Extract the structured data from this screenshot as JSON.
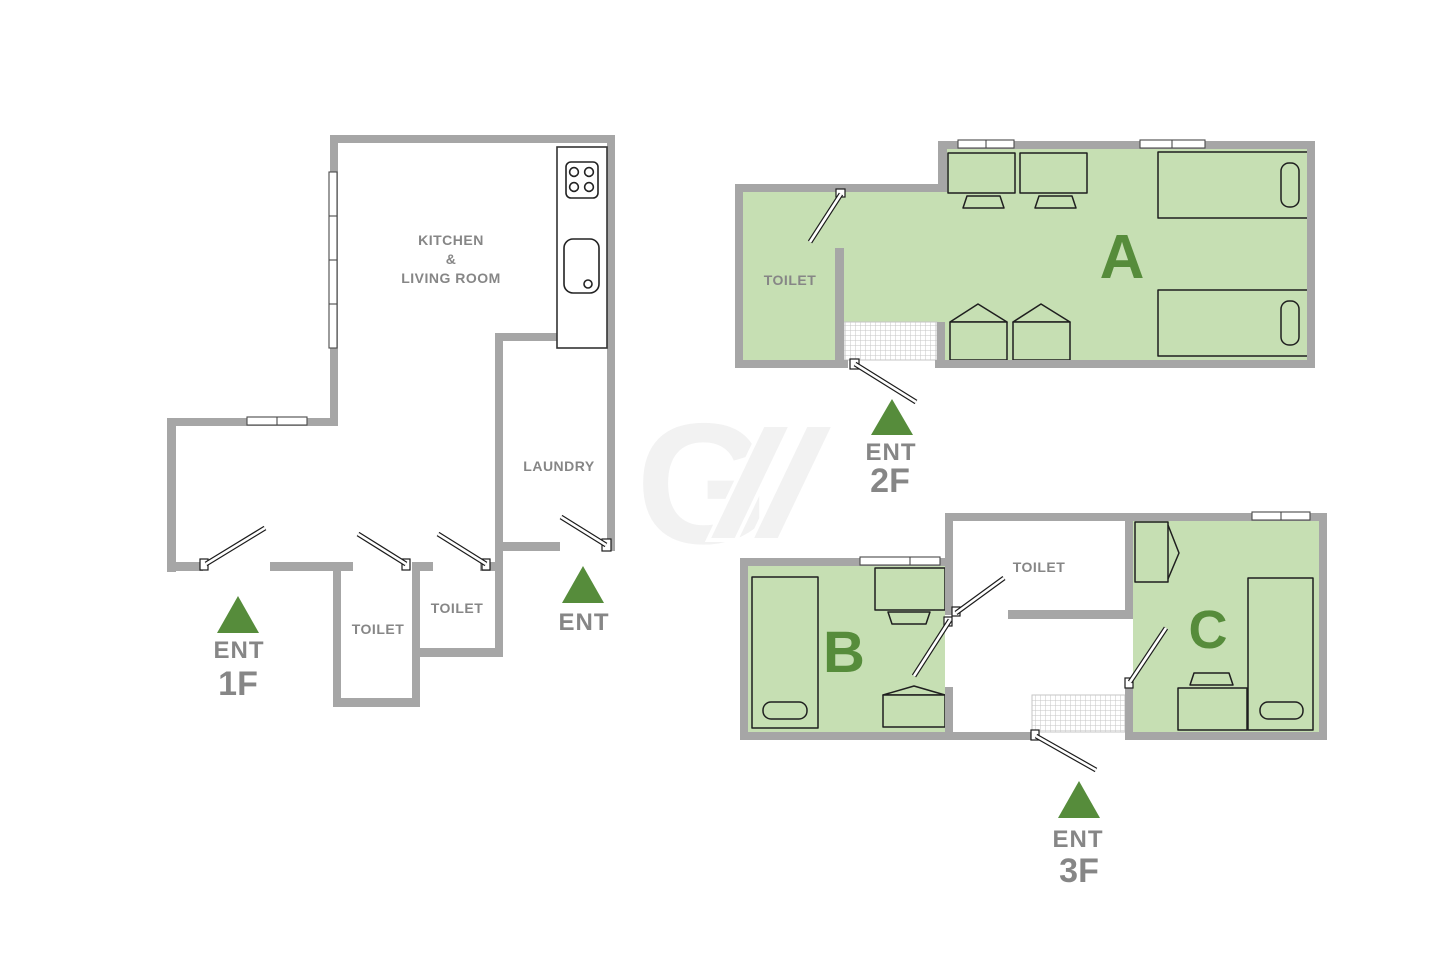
{
  "colors": {
    "wall": "#a6a6a6",
    "room_green": "#c6dfb3",
    "accent_green": "#568c3b",
    "label_gray": "#868686",
    "furniture_stroke": "#1f1f1f",
    "hatch_line": "#c6c6c6",
    "watermark_gray": "#f2f2f2"
  },
  "watermark": {
    "letter": "G"
  },
  "f1": {
    "kitchen_lines": [
      "KITCHEN",
      "&",
      "LIVING ROOM"
    ],
    "laundry": "LAUNDRY",
    "toilet_a": "TOILET",
    "toilet_b": "TOILET",
    "ent_front": "ENT",
    "ent_side": "ENT",
    "floor": "1F"
  },
  "f2": {
    "unit": "A",
    "toilet": "TOILET",
    "ent": "ENT",
    "floor": "2F"
  },
  "f3": {
    "unit_b": "B",
    "unit_c": "C",
    "toilet": "TOILET",
    "ent": "ENT",
    "floor": "3F"
  }
}
